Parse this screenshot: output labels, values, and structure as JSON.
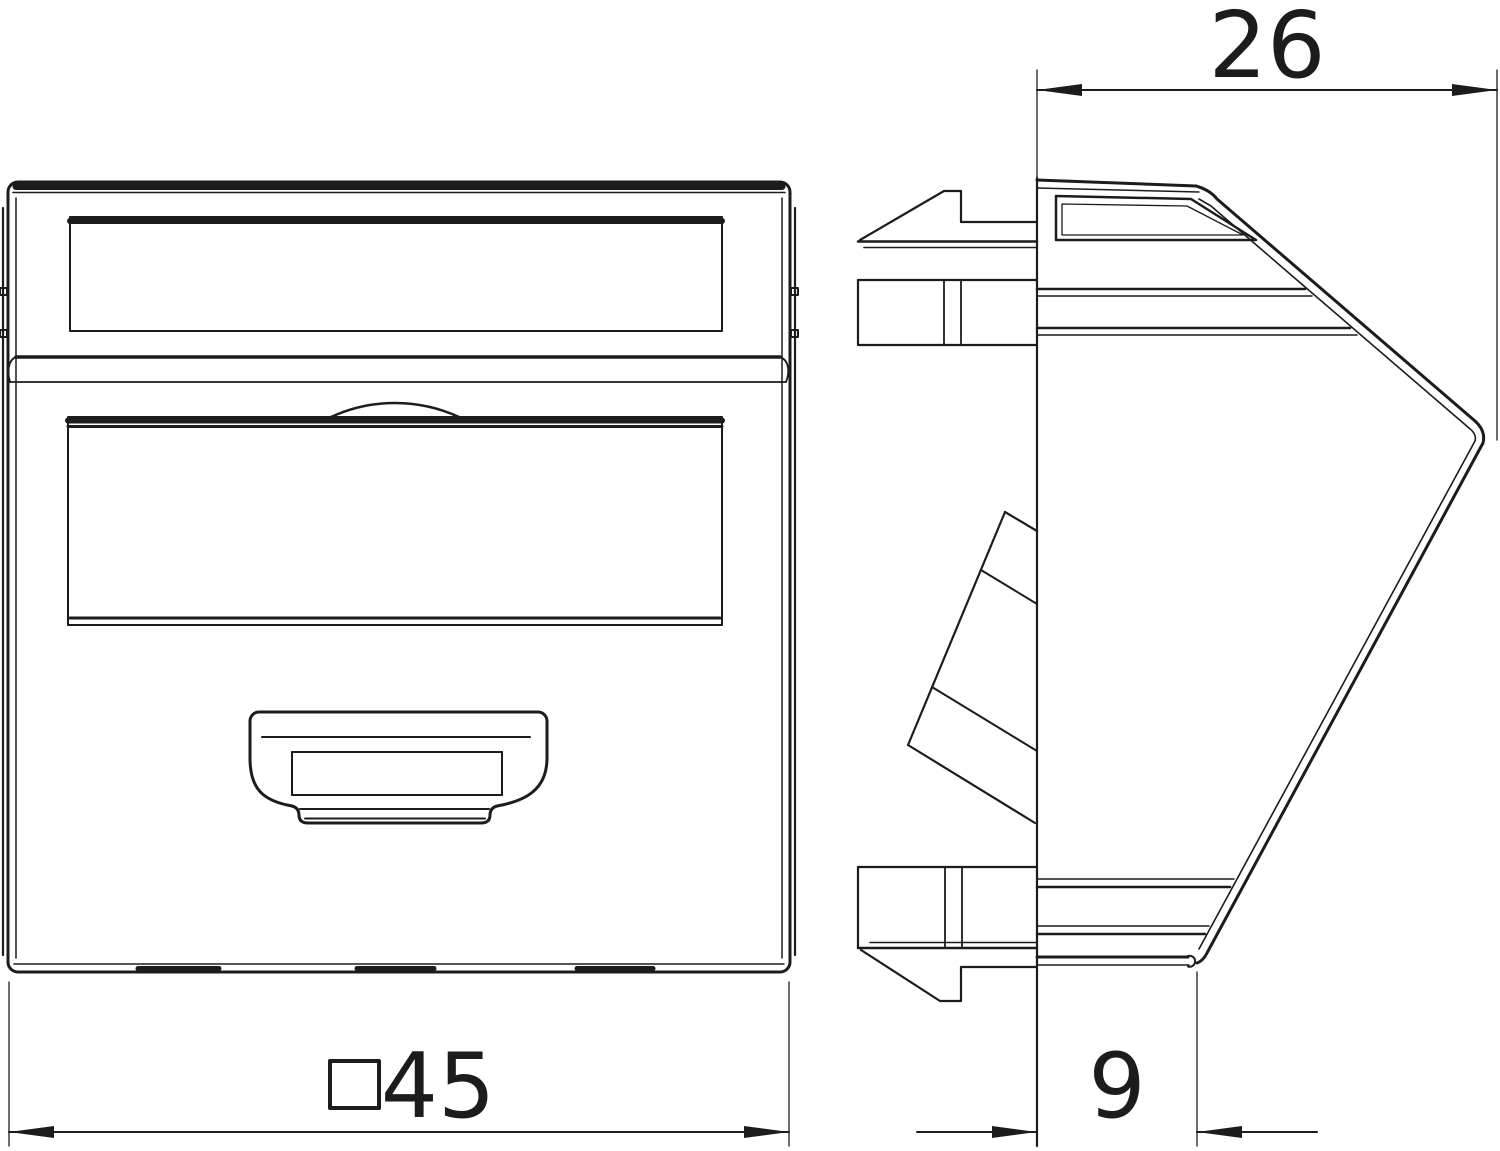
{
  "drawing": {
    "type": "technical-dimension-drawing",
    "description": "Two orthographic views of a 45x45 data-socket cover plate: front view (left) and side profile with mounting claws (right)",
    "colors": {
      "line": "#1c1c1c",
      "background": "#ffffff"
    },
    "views": {
      "front": {
        "name": "front view"
      },
      "side": {
        "name": "side profile view"
      }
    },
    "dimensions": {
      "top_depth": {
        "label": "26",
        "units_implied": "mm"
      },
      "bottom_width": {
        "label": "45",
        "square_symbol": true,
        "units_implied": "mm"
      },
      "bottom_depth": {
        "label": "9",
        "units_implied": "mm"
      }
    }
  }
}
